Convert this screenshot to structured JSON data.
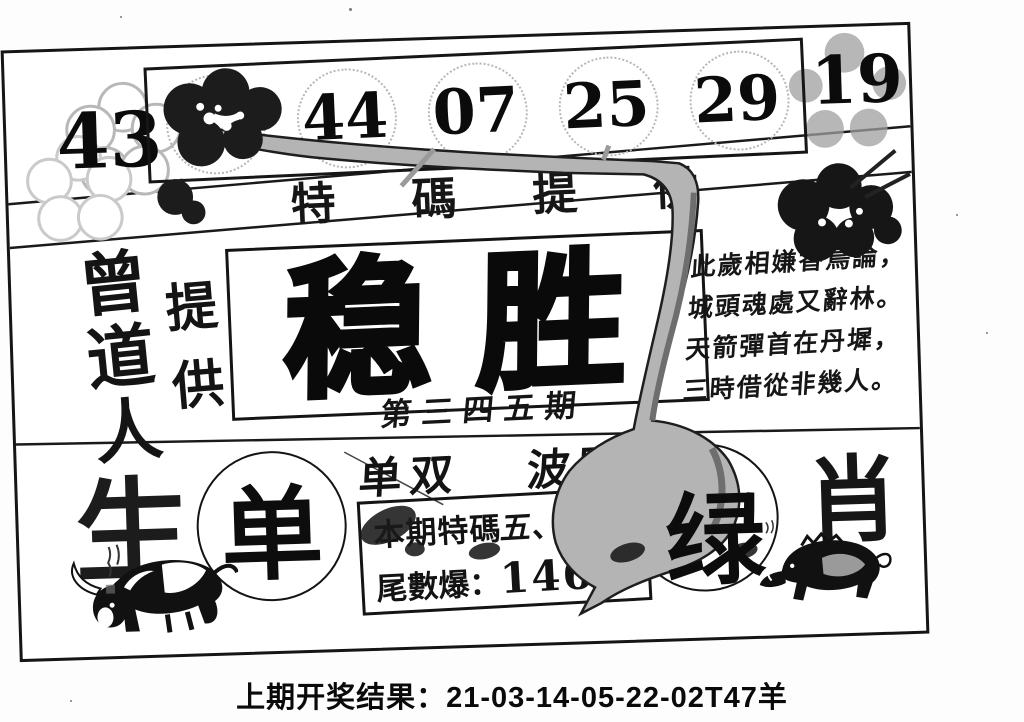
{
  "card": {
    "top_numbers": {
      "left": "43",
      "boxed": [
        "17",
        "44",
        "07",
        "25",
        "29"
      ],
      "right": "19"
    },
    "subtitle": {
      "chars": [
        "特",
        "碼",
        "提",
        "供"
      ]
    },
    "provider": {
      "name": "曾道人",
      "label": "提供"
    },
    "main": {
      "title": "稳胜",
      "issue": "第三四五期"
    },
    "poem": {
      "lines": [
        "此歲相嫌香鳥論，",
        "城頭魂處又辭林。",
        "天箭彈首在丹墀，",
        "三時借從非幾人。"
      ]
    },
    "bottom": {
      "zodiac_char": "生",
      "odd_pick": "单",
      "dan_shuang_label": "单双",
      "bo_lu_label": "波路",
      "tip_box": {
        "line1_prefix": "本期特碼",
        "line1_hand": "五、一門,",
        "line2_label": "尾數爆",
        "line2_sep": "：",
        "line2_value": "146"
      },
      "color_pick": "绿",
      "xiao_char": "肖"
    },
    "art": {
      "ox": "ox-ink-painting",
      "boar": "boar-ink-painting",
      "plum": "plum-branch-and-blossoms"
    }
  },
  "footer": {
    "text": "上期开奖结果：21-03-14-05-22-02T47羊"
  },
  "colors": {
    "ink": "#111111",
    "branch_gray": "#b4b4b4",
    "petal_gray": "#9f9f9f",
    "outline_gray": "#bdbdbd"
  }
}
